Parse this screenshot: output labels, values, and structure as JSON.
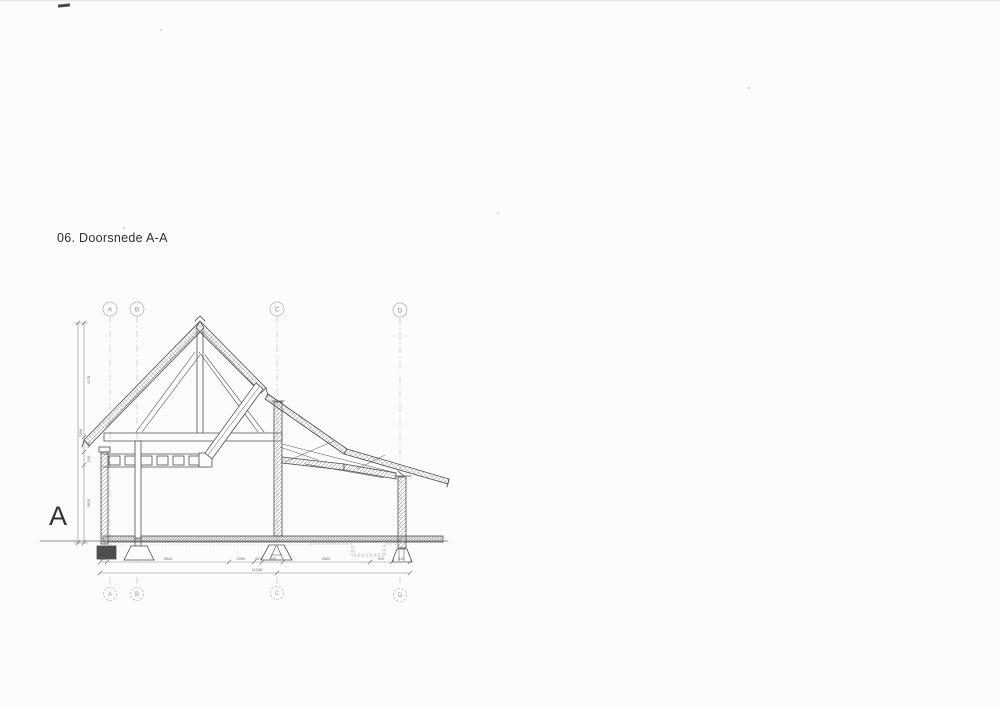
{
  "page": {
    "title": "06. Doorsnede A-A",
    "section_label": "A"
  },
  "grid_bubbles": {
    "top": [
      "A",
      "B",
      "C",
      "D"
    ],
    "bottom": [
      "A",
      "B",
      "C",
      "D"
    ]
  },
  "dimensions": {
    "vertical": {
      "total": "7306",
      "segments": [
        "4178",
        "580",
        "250",
        "2620"
      ]
    },
    "horizontal": {
      "segments": [
        "235",
        "3544",
        "2250",
        "407",
        "905",
        "2600",
        "910",
        "311"
      ],
      "total": "11248"
    }
  },
  "colors": {
    "ink": "#4f4f4f",
    "grid_line": "#b8b8b8",
    "dim_line": "#8a8a8a",
    "paper": "#fcfcfc"
  }
}
